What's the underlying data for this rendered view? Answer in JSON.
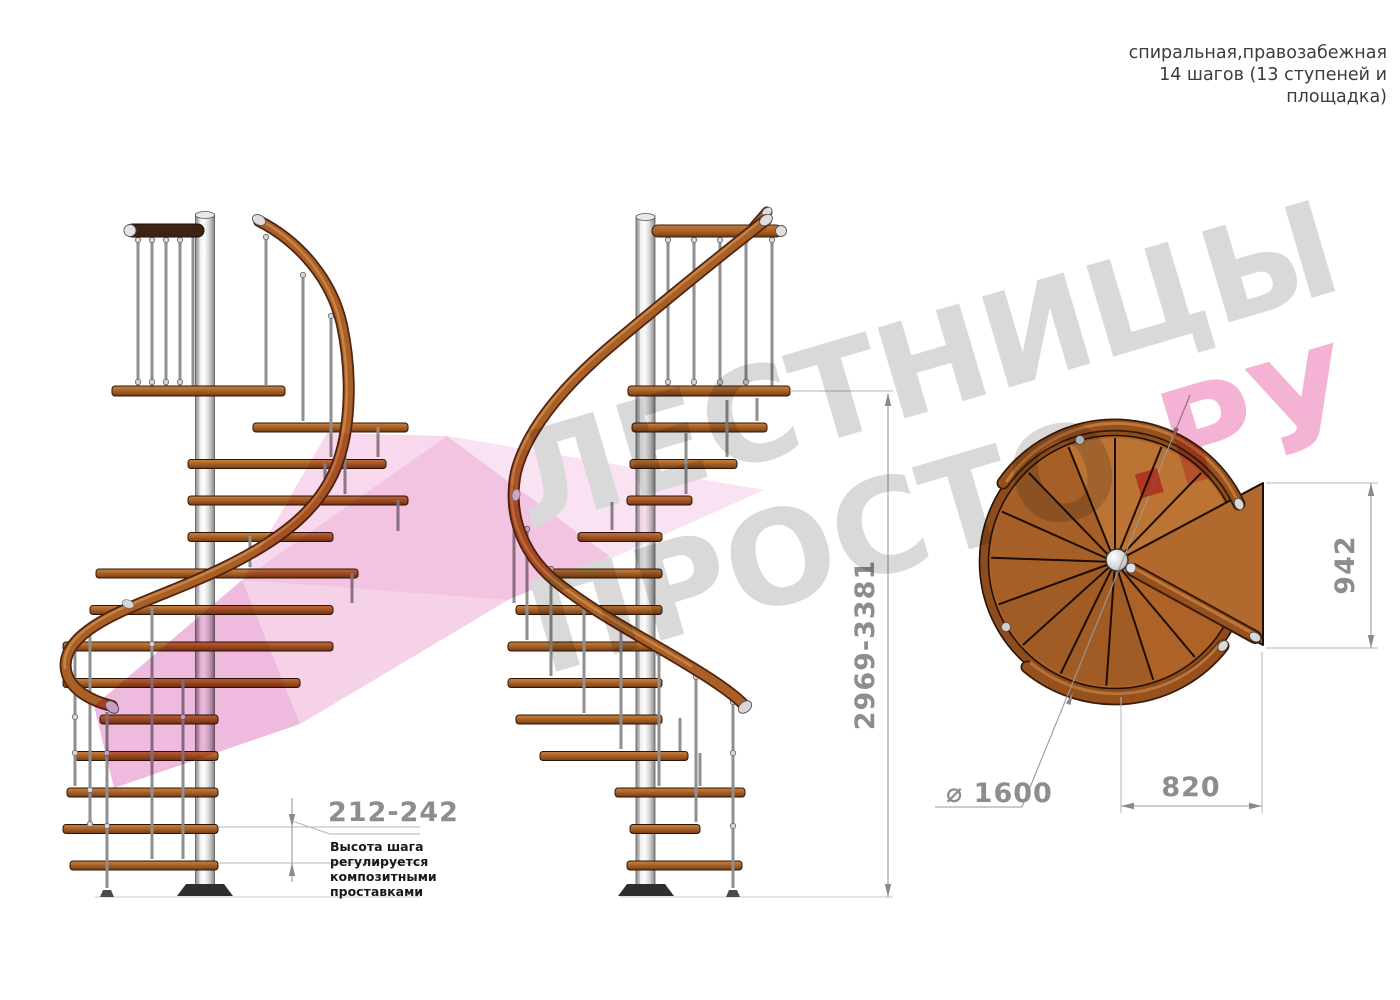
{
  "header": {
    "line1": "спиральная,правозабежная",
    "line2": "14 шагов (13 ступеней и",
    "line3": "площадка)"
  },
  "watermark": {
    "row1": "ЛЕСТНИЦЫ",
    "row2_gray": "ПРОСТО",
    "row2_dot": ".",
    "row2_pink": "РУ",
    "gray": "#d9d9d9",
    "pink": "#f4b2d4",
    "dot_red": "#ec7a96",
    "ribbon_pink": "#f3c8e4"
  },
  "dimensions": {
    "total_height": "2969-3381",
    "step_height": "212-242",
    "step_height_note": [
      "Высота шага",
      "регулируется",
      "композитными",
      "проставками"
    ],
    "plan_height": "942",
    "landing_width": "820",
    "diameter_symbol": "⌀ ",
    "diameter_value": "1600"
  },
  "colors": {
    "wood_light": "#c9833f",
    "wood_mid": "#a9652c",
    "wood_dark": "#6f3a14",
    "rail_outline": "#4f2410",
    "metal": "#c9c9c9",
    "dimension_gray": "#8d8d8d",
    "note_black": "#1a1a1a"
  }
}
